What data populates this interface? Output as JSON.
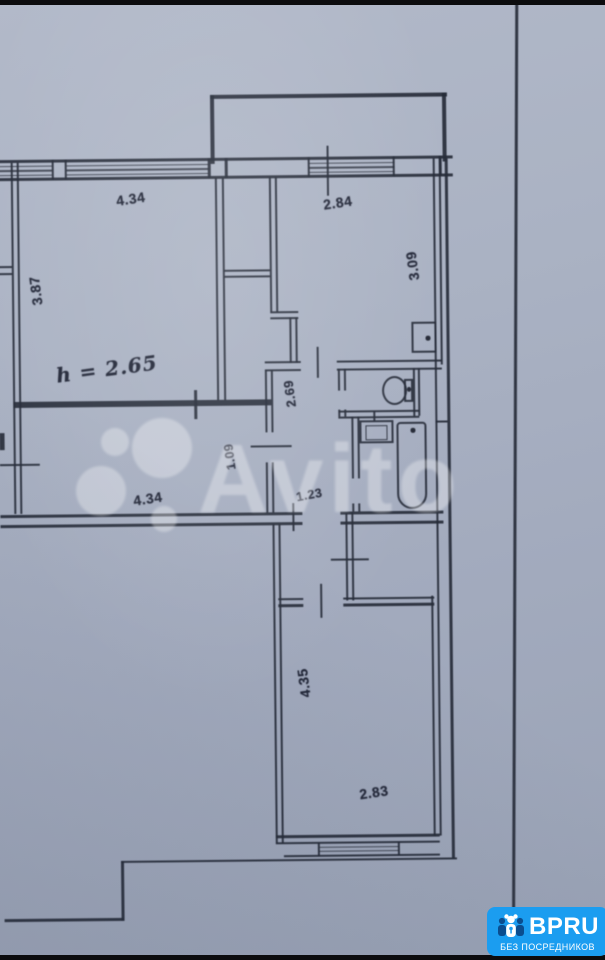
{
  "photo": {
    "paper_color": "#a8b0c2",
    "line_color": "#2b3040",
    "letterbox_color": "#0c0c0e"
  },
  "floorplan": {
    "living_room": {
      "width": "4.34",
      "depth": "3.87",
      "ceiling_height": "h = 2.65"
    },
    "kitchen": {
      "width": "2.84",
      "depth": "3.09"
    },
    "hall": {
      "width": "4.34",
      "depth": "1.09"
    },
    "corridor": {
      "upper_length": "2.69",
      "width": "1.23"
    },
    "bottom_room": {
      "width": "2.83",
      "depth": "4.35"
    }
  },
  "watermark": {
    "brand": "Avito"
  },
  "badge": {
    "brand": "BPRU",
    "tagline": "БЕЗ ПОСРЕДНИКОВ",
    "background": "#1b9df0"
  }
}
